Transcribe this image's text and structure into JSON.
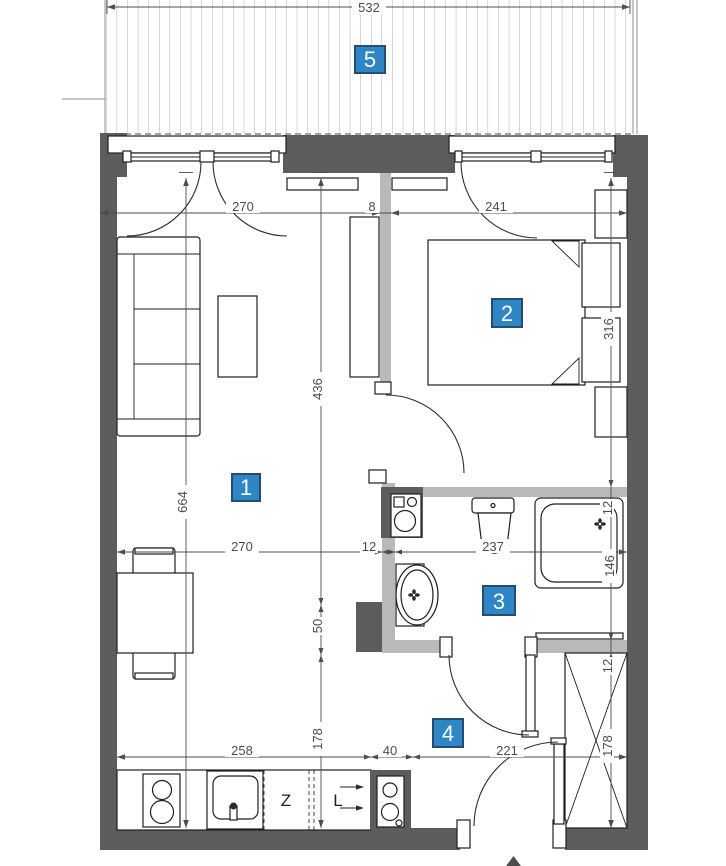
{
  "colors": {
    "wall_dark": "#5c5c5c",
    "wall_light": "#b9b9b9",
    "hatch": "#a9a9a9",
    "dim": "#4d4d4d",
    "line": "#1f1f1f",
    "room_label_fill": "#2f86c5",
    "room_label_border": "#274b73"
  },
  "room_labels": {
    "living": "1",
    "bedroom": "2",
    "bathroom": "3",
    "hall": "4",
    "balcony": "5"
  },
  "kitchen": {
    "dishwasher_label": "Z",
    "fridge_label": "L"
  },
  "dimensions": {
    "balcony_width": "532",
    "living_width_top": "270",
    "partition_thickness": "8",
    "bedroom_width": "241",
    "living_height_upper": "436",
    "bedroom_depth": "316",
    "living_height_total": "664",
    "living_width_mid": "270",
    "bath_wall_thickness": "12",
    "bathroom_width": "237",
    "shower_top_offset": "12",
    "shower_length": "146",
    "mid_gap": "50",
    "hall_wall_thickness": "12",
    "kitchen_run": "258",
    "appliance_niche": "40",
    "hall_width": "221",
    "wardrobe_height": "178",
    "kitchen_zone_height": "178"
  }
}
